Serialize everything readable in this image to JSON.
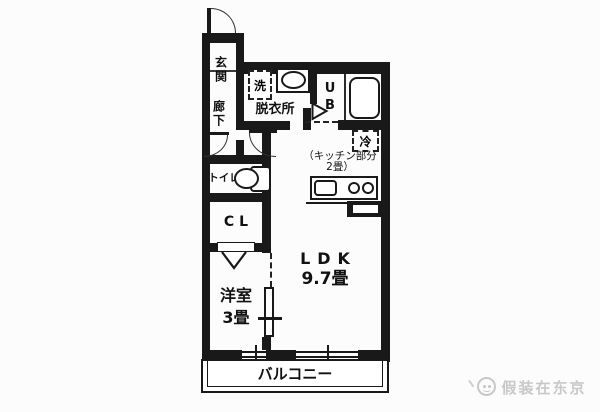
{
  "rooms": {
    "genkan": "玄関",
    "hallway": "廊下",
    "washer": "洗",
    "dressing": "脱衣所",
    "bath_u": "U",
    "bath_b": "B",
    "fridge": "冷",
    "kitchen_note1": "（キッチン部分",
    "kitchen_note2": "2畳）",
    "toilet": "トイレ",
    "closet": "CL",
    "western_room": "洋室",
    "western_size": "3畳",
    "ldk": "LDK",
    "ldk_size": "9.7畳",
    "balcony": "バルコニー"
  },
  "watermark": {
    "text": "假装在东京"
  },
  "colors": {
    "wall": "#191919",
    "background": "#fcfcfc",
    "watermark_gray": "#c8c8c8"
  }
}
